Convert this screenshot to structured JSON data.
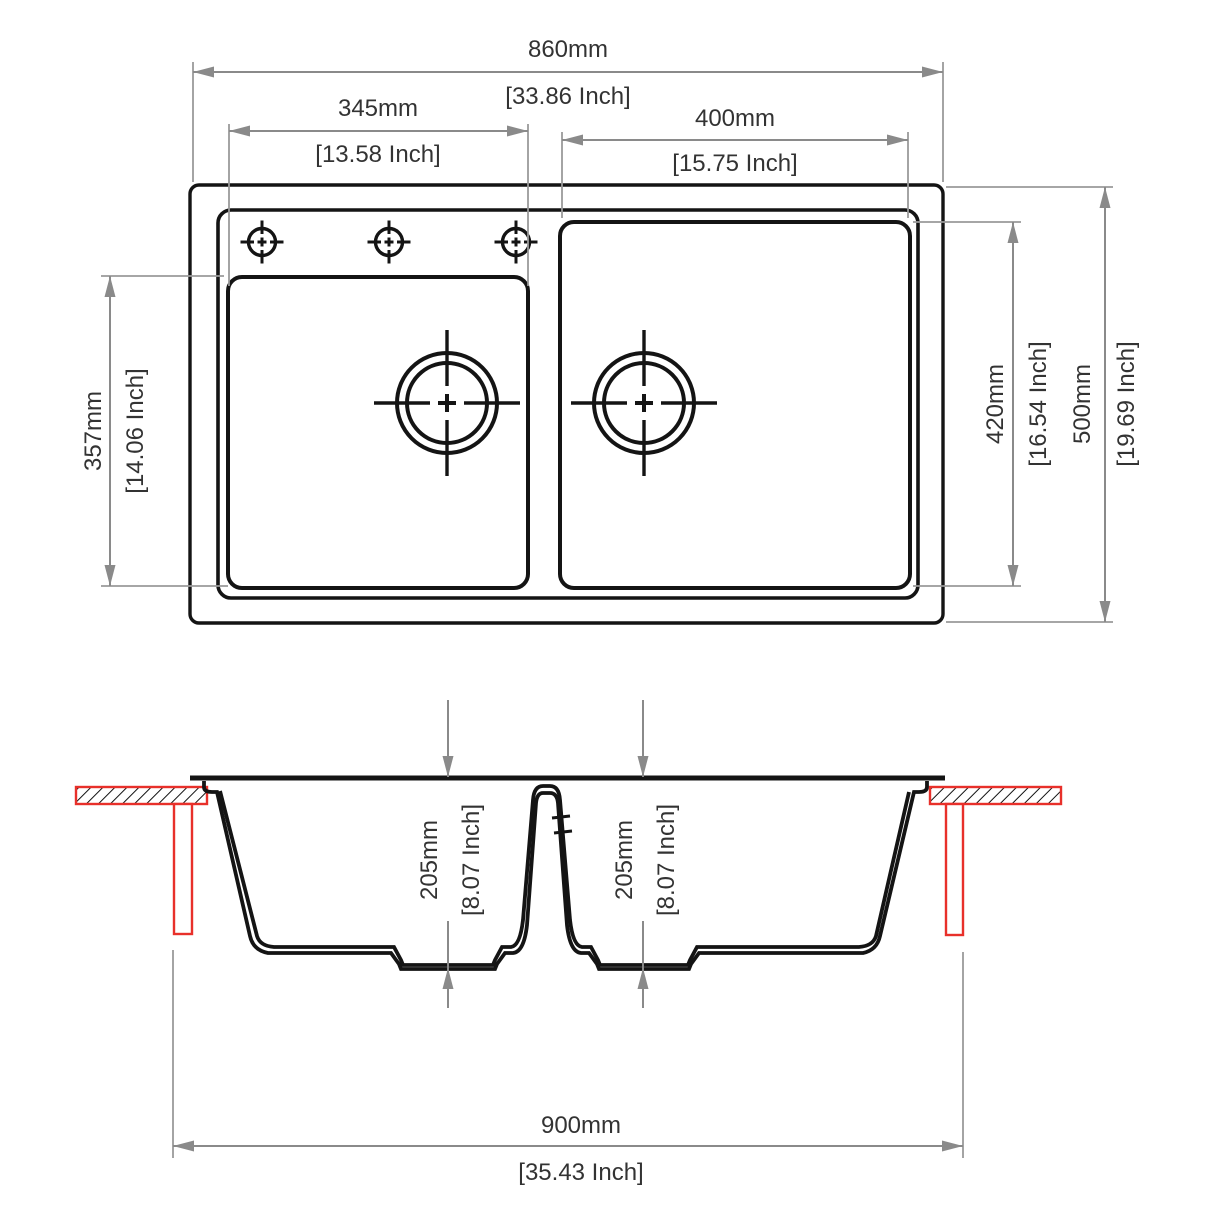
{
  "colors": {
    "background": "#ffffff",
    "drawing_line": "#141414",
    "dimension_line": "#8a8a8a",
    "dimension_text": "#333333",
    "counter_red": "#e8302a"
  },
  "top_view": {
    "overall_width": {
      "mm": "860mm",
      "inch": "[33.86 Inch]"
    },
    "left_bowl_width": {
      "mm": "345mm",
      "inch": "[13.58 Inch]"
    },
    "right_bowl_width": {
      "mm": "400mm",
      "inch": "[15.75 Inch]"
    },
    "left_bowl_front_to_back": {
      "mm": "357mm",
      "inch": "[14.06 Inch]"
    },
    "right_bowl_front_to_back": {
      "mm": "420mm",
      "inch": "[16.54 Inch]"
    },
    "overall_front_to_back": {
      "mm": "500mm",
      "inch": "[19.69 Inch]"
    },
    "faucet_hole_count": "3",
    "bowl_count": "2"
  },
  "section_view": {
    "left_bowl_depth": {
      "mm": "205mm",
      "inch": "[8.07 Inch]"
    },
    "right_bowl_depth": {
      "mm": "205mm",
      "inch": "[8.07 Inch]"
    },
    "cabinet_width": {
      "mm": "900mm",
      "inch": "[35.43 Inch]"
    }
  }
}
